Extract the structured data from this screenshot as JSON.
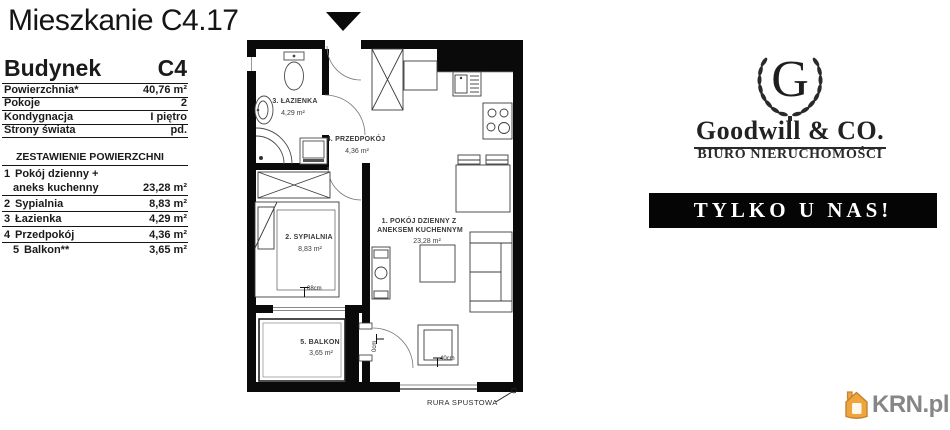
{
  "page_title": "Mieszkanie C4.17",
  "details": {
    "building_label": "Budynek",
    "building_value": "C4",
    "rows": [
      {
        "label": "Powierzchnia*",
        "value": "40,76 m²"
      },
      {
        "label": "Pokoje",
        "value": "2"
      },
      {
        "label": "Kondygnacja",
        "value": "I piętro"
      },
      {
        "label": "Strony świata",
        "value": "pd."
      }
    ]
  },
  "areas": {
    "header": "ZESTAWIENIE POWIERZCHNI",
    "rows": [
      {
        "num": "1",
        "label": "Pokój dzienny +",
        "label2": "aneks kuchenny",
        "value": "23,28 m²"
      },
      {
        "num": "2",
        "label": "Sypialnia",
        "value": "8,83 m²"
      },
      {
        "num": "3",
        "label": "Łazienka",
        "value": "4,29 m²"
      },
      {
        "num": "4",
        "label": "Przedpokój",
        "value": "4,36 m²"
      },
      {
        "num": "5",
        "label": "Balkon**",
        "value": "3,65 m²"
      }
    ]
  },
  "plan": {
    "rooms": {
      "living": {
        "name": "1. POKÓJ DZIENNY Z",
        "name2": "ANEKSEM KUCHENNYM",
        "area": "23,28 m²"
      },
      "bedroom": {
        "name": "2. SYPIALNIA",
        "area": "8,83 m²"
      },
      "bathroom": {
        "name": "3. ŁAZIENKA",
        "area": "4,29 m²"
      },
      "hall": {
        "name": "4. PRZEDPOKÓJ",
        "area": "4,36 m²"
      },
      "balcony": {
        "name": "5. BALKON",
        "area": "3,65 m²"
      }
    },
    "dims": {
      "bedroom_window": "88cm",
      "living_window": "40cm",
      "balcony_door": "0cm"
    },
    "downpipe_label": "RURA SPUSTOWA"
  },
  "brand": {
    "monogram": "G",
    "name": "Goodwill & CO.",
    "subtitle": "BIURO NIERUCHOMOŚCI",
    "banner": "TYLKO U NAS!",
    "colors": {
      "banner_bg": "#050505",
      "banner_text": "#ffffff"
    }
  },
  "watermark": {
    "text": "KRN.pl",
    "house_color": "#f0a43c",
    "house_stroke": "#c18430",
    "text_color": "#868686"
  }
}
